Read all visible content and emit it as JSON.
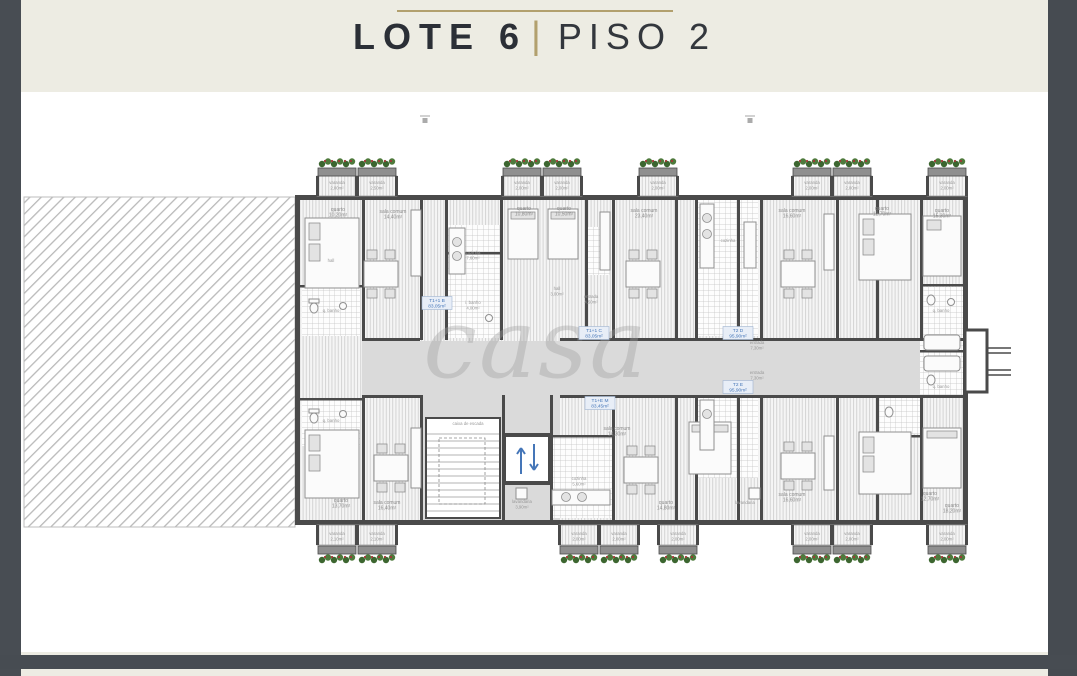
{
  "header": {
    "title_bold": "LOTE 6",
    "divider": "|",
    "title_light": "PISO 2"
  },
  "watermark": "casa",
  "colors": {
    "page_cream": "#edece3",
    "border_dark": "#484d53",
    "accent_gold": "#b2a06e",
    "title_dark": "#2b2f36",
    "plan_wall": "#4a4a4a",
    "corridor_gray": "#dadada",
    "tag_blue": "#4576b8",
    "plant_green": "#4e7a3c",
    "plant_red": "#a23737"
  },
  "plan": {
    "labels": [
      {
        "x": 316,
        "y": 92,
        "t": "varanda",
        "a": "2,00m²",
        "c": "tiny"
      },
      {
        "x": 356,
        "y": 92,
        "t": "varanda",
        "a": "2,50m²",
        "c": "tiny"
      },
      {
        "x": 501,
        "y": 92,
        "t": "varanda",
        "a": "2,00m²",
        "c": "tiny"
      },
      {
        "x": 541,
        "y": 92,
        "t": "varanda",
        "a": "2,00m²",
        "c": "tiny"
      },
      {
        "x": 637,
        "y": 92,
        "t": "varanda",
        "a": "2,00m²",
        "c": "tiny"
      },
      {
        "x": 791,
        "y": 92,
        "t": "varanda",
        "a": "2,00m²",
        "c": "tiny"
      },
      {
        "x": 831,
        "y": 92,
        "t": "varanda",
        "a": "2,00m²",
        "c": "tiny"
      },
      {
        "x": 926,
        "y": 92,
        "t": "varanda",
        "a": "2,00m²",
        "c": "tiny"
      },
      {
        "x": 317,
        "y": 119,
        "t": "quarto",
        "a": "10,20m²",
        "c": "room"
      },
      {
        "x": 372,
        "y": 121,
        "t": "sala comum",
        "a": "14,40m²",
        "c": "room"
      },
      {
        "x": 503,
        "y": 118,
        "t": "quarto",
        "a": "10,80m²",
        "c": "room"
      },
      {
        "x": 543,
        "y": 118,
        "t": "quarto",
        "a": "10,50m²",
        "c": "room"
      },
      {
        "x": 623,
        "y": 120,
        "t": "sala comum",
        "a": "23,40m²",
        "c": "room"
      },
      {
        "x": 771,
        "y": 120,
        "t": "sala comum",
        "a": "16,60m²",
        "c": "room"
      },
      {
        "x": 861,
        "y": 118,
        "t": "quarto",
        "a": "12,70m²",
        "c": "room"
      },
      {
        "x": 921,
        "y": 120,
        "t": "quarto",
        "a": "15,30m²",
        "c": "room"
      },
      {
        "x": 452,
        "y": 162,
        "t": "cozinha",
        "a": "7,60m²",
        "c": "tiny"
      },
      {
        "x": 452,
        "y": 212,
        "t": "i. banho",
        "a": "4,00m²",
        "c": "tiny"
      },
      {
        "x": 310,
        "y": 170,
        "t": "hall",
        "a": "",
        "c": "tiny"
      },
      {
        "x": 310,
        "y": 220,
        "t": "q. banho",
        "a": "",
        "c": "tiny"
      },
      {
        "x": 310,
        "y": 330,
        "t": "q. banho",
        "a": "",
        "c": "tiny"
      },
      {
        "x": 536,
        "y": 198,
        "t": "hall",
        "a": "3,00m²",
        "c": "tiny"
      },
      {
        "x": 570,
        "y": 206,
        "t": "entrada",
        "a": "4,50m²",
        "c": "tiny"
      },
      {
        "x": 707,
        "y": 150,
        "t": "cozinha",
        "a": "",
        "c": "tiny"
      },
      {
        "x": 736,
        "y": 252,
        "t": "entrada",
        "a": "7,30m²",
        "c": "tiny"
      },
      {
        "x": 736,
        "y": 282,
        "t": "entrada",
        "a": "7,30m²",
        "c": "tiny"
      },
      {
        "x": 920,
        "y": 220,
        "t": "q. banho",
        "a": "",
        "c": "tiny"
      },
      {
        "x": 920,
        "y": 296,
        "t": "q. banho",
        "a": "",
        "c": "tiny"
      },
      {
        "x": 447,
        "y": 333,
        "t": "caixa de escada",
        "a": "",
        "c": "tiny"
      },
      {
        "x": 596,
        "y": 338,
        "t": "sala comum",
        "a": "14,30m²",
        "c": "room"
      },
      {
        "x": 558,
        "y": 388,
        "t": "cozinha",
        "a": "5,60m²",
        "c": "tiny"
      },
      {
        "x": 501,
        "y": 411,
        "t": "lavandaria",
        "a": "3,90m²",
        "c": "tiny"
      },
      {
        "x": 320,
        "y": 410,
        "t": "quarto",
        "a": "13,70m²",
        "c": "room"
      },
      {
        "x": 366,
        "y": 412,
        "t": "sala comum",
        "a": "16,40m²",
        "c": "room"
      },
      {
        "x": 645,
        "y": 412,
        "t": "quarto",
        "a": "14,80m²",
        "c": "room"
      },
      {
        "x": 771,
        "y": 404,
        "t": "sala comum",
        "a": "16,60m²",
        "c": "room"
      },
      {
        "x": 724,
        "y": 412,
        "t": "lavandaria",
        "a": "",
        "c": "tiny"
      },
      {
        "x": 909,
        "y": 403,
        "t": "quarto",
        "a": "12,70m²",
        "c": "room"
      },
      {
        "x": 931,
        "y": 415,
        "t": "quarto",
        "a": "18,20m²",
        "c": "room"
      },
      {
        "x": 316,
        "y": 443,
        "t": "varanda",
        "a": "2,10m²",
        "c": "tiny"
      },
      {
        "x": 356,
        "y": 443,
        "t": "varanda",
        "a": "2,10m²",
        "c": "tiny"
      },
      {
        "x": 558,
        "y": 443,
        "t": "varanda",
        "a": "2,00m²",
        "c": "tiny"
      },
      {
        "x": 598,
        "y": 443,
        "t": "varanda",
        "a": "2,00m²",
        "c": "tiny"
      },
      {
        "x": 657,
        "y": 443,
        "t": "varanda",
        "a": "2,00m²",
        "c": "tiny"
      },
      {
        "x": 791,
        "y": 443,
        "t": "varanda",
        "a": "2,00m²",
        "c": "tiny"
      },
      {
        "x": 831,
        "y": 443,
        "t": "varanda",
        "a": "2,00m²",
        "c": "tiny"
      },
      {
        "x": 926,
        "y": 443,
        "t": "varanda",
        "a": "2,00m²",
        "c": "tiny"
      }
    ],
    "apartment_tags": [
      {
        "x": 416,
        "y": 210,
        "t": "T1+1 B",
        "a": "83,05m²"
      },
      {
        "x": 573,
        "y": 240,
        "t": "T1+1 C",
        "a": "83,05m²"
      },
      {
        "x": 579,
        "y": 310,
        "t": "T1+E M",
        "a": "83,45m²"
      },
      {
        "x": 717,
        "y": 240,
        "t": "T2 D",
        "a": "95,90m²"
      },
      {
        "x": 717,
        "y": 294,
        "t": "T2 E",
        "a": "95,90m²"
      }
    ],
    "balconies_top": [
      316,
      356,
      501,
      541,
      637,
      791,
      831,
      926
    ],
    "balconies_bottom": [
      316,
      356,
      558,
      598,
      657,
      791,
      831,
      926
    ],
    "section_markers": [
      {
        "x": 404,
        "y": 26
      },
      {
        "x": 729,
        "y": 26
      }
    ]
  }
}
